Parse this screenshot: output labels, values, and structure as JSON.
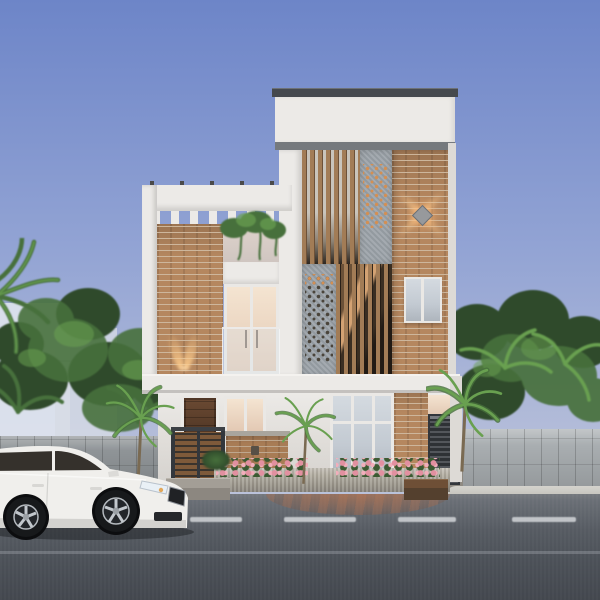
{
  "scene": {
    "type": "architectural-exterior-render",
    "time_of_day": "dusk",
    "description": "Street elevation of a modern three-storey house at dusk: white rendered walls with brick feature columns, a vertical timber slat staircase screen, two perforated grey jali panels, rooftop pergola with white louvres, warm interior lighting, a diamond wall sconce casting an X of light on the brick, glass balcony railing, flowering planters and palms, grey stone compound walls with trees behind, a white sedan parked on the asphalt road with dashed lane markings and a brick paver driveway apron.",
    "house": {
      "storeys": 3,
      "features": [
        "rooftop pergola with white louvres",
        "brick feature columns",
        "vertical timber slat screen over staircase",
        "perforated jali panels (upper-right warm lit, mid-left dark)",
        "diamond wall light with four-point beam",
        "twin uplights on left brick column",
        "glass balcony railing with lit interior",
        "dark timber entry door behind slatted gate",
        "brick accent wall with small fixture",
        "full-height glazing on ground floor right",
        "dark metal side gate with warm glass above",
        "stone plinth planter with pink flowers"
      ]
    },
    "street": {
      "lane_dashes": 4,
      "has_faint_second_line": true,
      "apron": "brick paver fan in front of plinth",
      "kerb": "light concrete kerb on right"
    },
    "vehicle": {
      "type": "sedan",
      "color_name": "white",
      "position": "parked at left, facing right",
      "visible_wheels": 2
    },
    "vegetation": [
      "coconut palm fronds top-left",
      "tree clusters behind both walls",
      "three foreground palms",
      "terrace creepers on left wing",
      "shrubs at planter"
    ]
  },
  "colors": {
    "sky-top": "#6d85c8",
    "sky-mid": "#93a4d4",
    "sky-low": "#c7cbdc",
    "wall-white": "#eceae7",
    "wall-dim": "#dddad6",
    "coping": "#45494e",
    "shadow-band": "#75797d",
    "brick": "#b5875f",
    "mortar": "#cdb69c",
    "wood": "#a27c56",
    "wood-edge": "#6d5138",
    "slat-gap-light": "#c9c4bb",
    "slat-gap-dark": "#2e2720",
    "stair-light": "#d3a273",
    "stair-dark": "#211a14",
    "panel-gray": "#9ba2a8",
    "panel-dot-warm": "#d48f52",
    "panel-dot-dark": "#4a443b",
    "glow-warm": "#ffc07a",
    "window-warm": "#f4e4d1",
    "window-warm-deep": "#e3c9b4",
    "window-cool": "#c3cad2",
    "frame-white": "#eae8e5",
    "door-brown": "#4e3524",
    "gate-wood": "#7e5a3a",
    "metal-dark": "#33373c",
    "stone-light": "#a9aeb1",
    "stone-dark": "#8f9497",
    "plinth": "#b2aca0",
    "curb": "#c6c5bf",
    "road-top": "#6a6f76",
    "road-bottom": "#43474e",
    "marking": "#d2d5d8",
    "leaf-dark": "#2f4a2b",
    "leaf-mid": "#47703c",
    "leaf-light": "#69a050",
    "trunk": "#7a6a52",
    "car-body": "#f0efec",
    "car-shade": "#d3d2cf",
    "car-glass": "#35312c",
    "tire": "#17191b",
    "rim": "#b4b9be",
    "flower-pink": "#e290a0",
    "flower-leaf": "#3c5a32"
  }
}
